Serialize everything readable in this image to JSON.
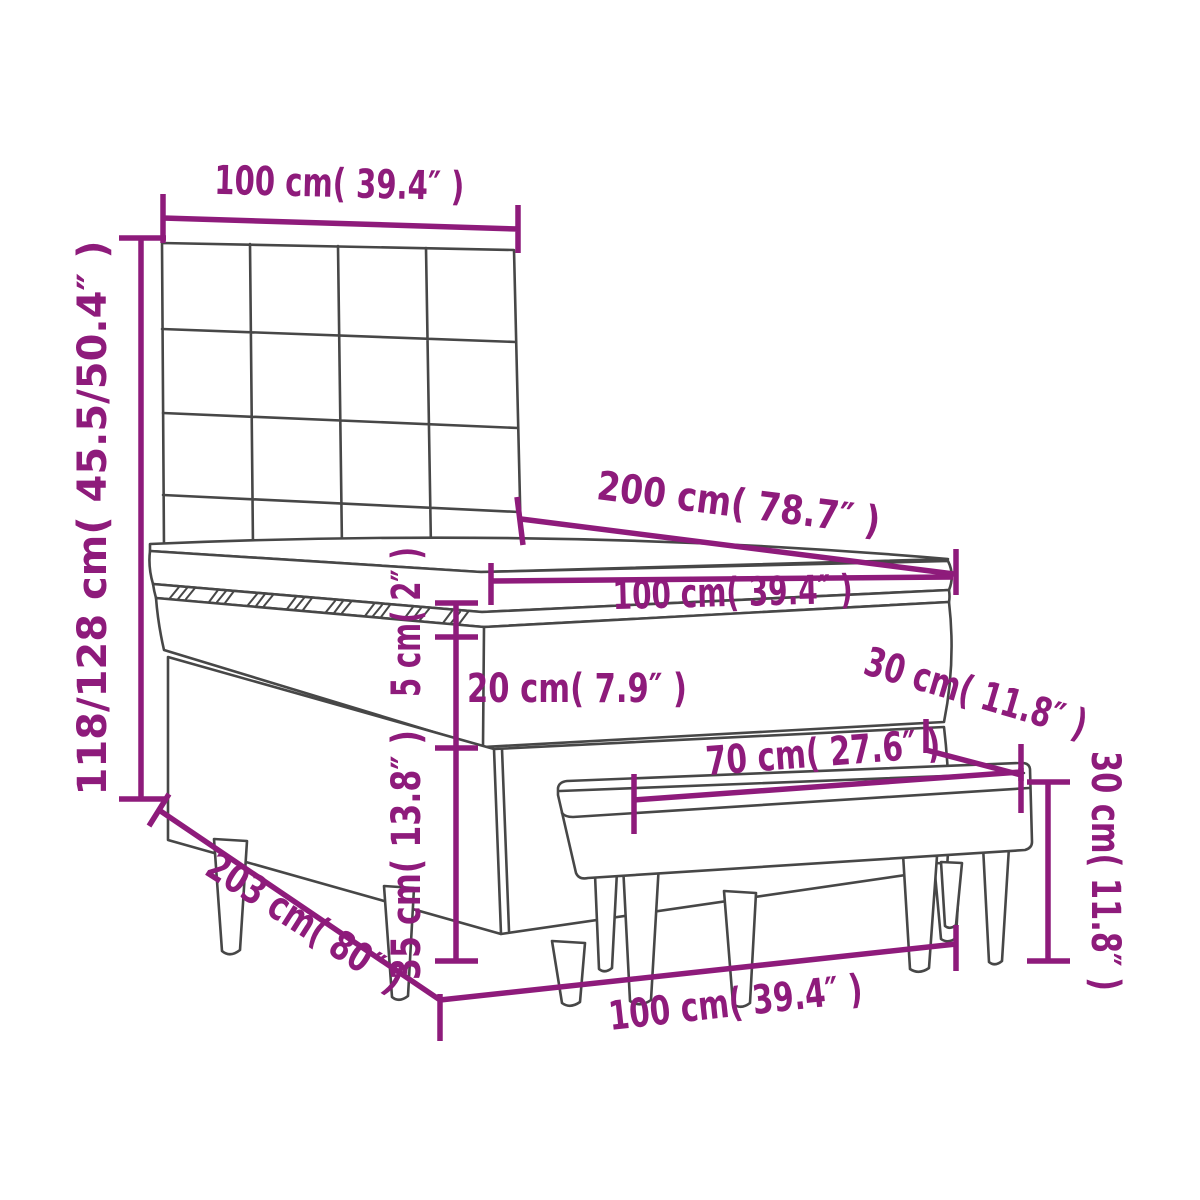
{
  "diagram": {
    "type": "furniture-dimension-diagram",
    "subject": "box spring bed with headboard and bench",
    "colors": {
      "background": "#ffffff",
      "dimension_color": "#8E1B7B",
      "outline_color": "#474747"
    },
    "labels": {
      "headboard_width": "100 cm( 39.4″ )",
      "overall_height": "118/128 cm( 45.5/50.4″ )",
      "bed_length": "200 cm( 78.7″ )",
      "mattress_width": "100 cm( 39.4″ )",
      "topper_thickness": "5 cm( 2″ )",
      "mattress_thickness": "20 cm( 7.9″ )",
      "base_height": "35 cm( 13.8″ )",
      "bench_depth": "30 cm( 11.8″ )",
      "bench_length": "70 cm( 27.6″ )",
      "bench_height": "30 cm( 11.8″ )",
      "frame_length": "203 cm( 80″ )",
      "frame_width": "100 cm( 39.4″ )"
    }
  }
}
